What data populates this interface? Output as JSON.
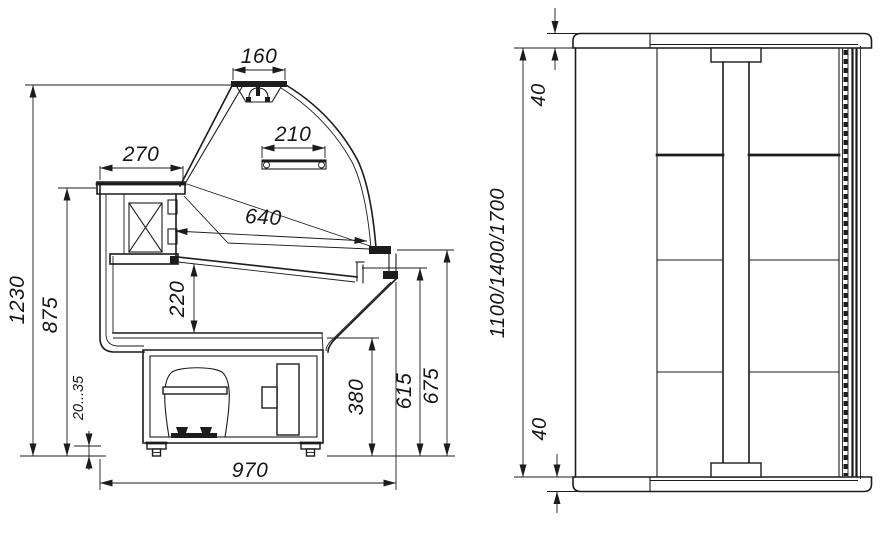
{
  "drawing": {
    "type": "technical-drawing",
    "subject": "refrigerated serve-over display counter, side section and front elevation",
    "units": "mm",
    "colors": {
      "line": "#1c1c1c",
      "background": "#ffffff"
    },
    "side_view": {
      "dim_canopy_width": "160",
      "dim_shelf_width": "210",
      "dim_top_ledge_depth": "270",
      "dim_display_opening": "640",
      "dim_overall_height": "1230",
      "dim_worktop_height": "875",
      "dim_well_depth": "220",
      "dim_leg_adjustment": "20...35",
      "dim_base_height": "380",
      "dim_deck_height": "615",
      "dim_front_glass_height": "675",
      "dim_overall_depth": "970"
    },
    "front_view": {
      "dim_top_profile": "40",
      "dim_bottom_profile": "40",
      "dim_length_variants": "1100/1400/1700"
    }
  }
}
